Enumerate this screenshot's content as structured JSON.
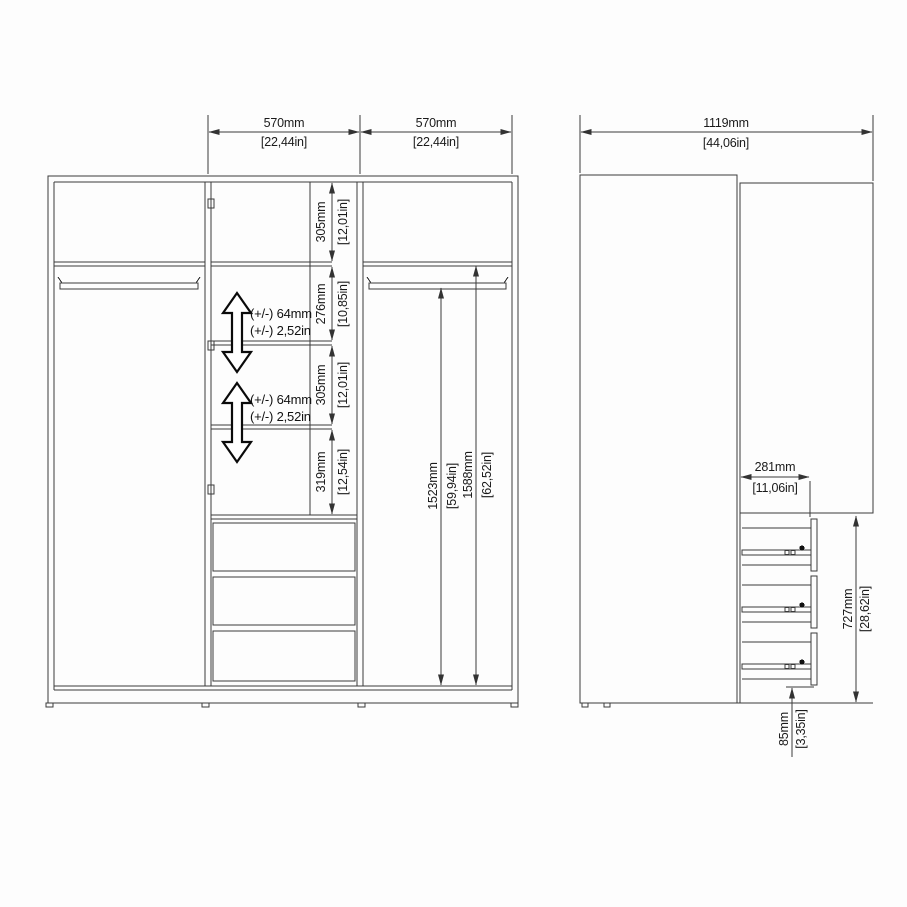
{
  "colors": {
    "line": "#3a3a3a",
    "text": "#1a1a1a",
    "background": "#fdfdfd"
  },
  "front_view": {
    "width_dims": [
      {
        "mm": "570mm",
        "in": "[22,44in]"
      },
      {
        "mm": "570mm",
        "in": "[22,44in]"
      }
    ],
    "shelf_dims": [
      {
        "mm": "305mm",
        "in": "[12,01in]"
      },
      {
        "mm": "276mm",
        "in": "[10,85in]"
      },
      {
        "mm": "305mm",
        "in": "[12,01in]"
      },
      {
        "mm": "319mm",
        "in": "[12,54in]"
      }
    ],
    "height_dims": [
      {
        "mm": "1523mm",
        "in": "[59,94in]"
      },
      {
        "mm": "1588mm",
        "in": "[62,52in]"
      }
    ],
    "adjustable": [
      {
        "mm": "(+/-) 64mm",
        "in": "(+/-) 2,52in"
      },
      {
        "mm": "(+/-) 64mm",
        "in": "(+/-) 2,52in"
      }
    ]
  },
  "side_view": {
    "width": {
      "mm": "1119mm",
      "in": "[44,06in]"
    },
    "depth": {
      "mm": "281mm",
      "in": "[11,06in]"
    },
    "drawer_stack": {
      "mm": "727mm",
      "in": "[28,62in]"
    },
    "plinth": {
      "mm": "85mm",
      "in": "[3,35in]"
    }
  }
}
